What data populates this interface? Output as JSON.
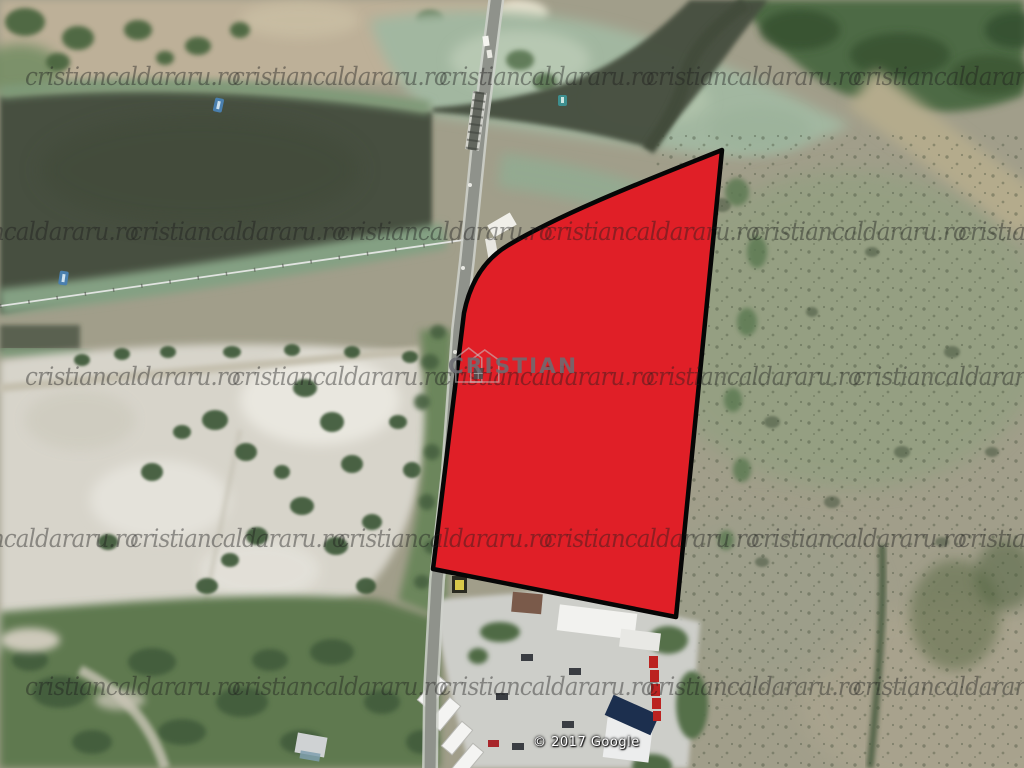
{
  "watermark": {
    "text": "cristiancaldararu.ro",
    "color": "rgba(28,28,28,0.42)"
  },
  "logo": {
    "name": "CRISTIAN",
    "icon": "double-house-outline-icon",
    "color": "#6c6c72"
  },
  "attribution": {
    "text": "© 2017 Google",
    "color": "#ffffff"
  },
  "parcel_overlay": {
    "shape": "land-parcel-polygon",
    "fill": "#e01f27",
    "stroke": "#000000",
    "description": "red highlighted land parcel east of the road"
  },
  "map_features": {
    "type": "satellite-imagery",
    "water": "dark river/lake band across upper left with reed marsh",
    "bridge": "road bridge crossing the river",
    "road": "north-south road left of the highlighted parcel",
    "terrain_left": "large cleared light dirt site with scattered trees",
    "terrain_right": "gray-green scrubland with bushes",
    "bottom_area": "industrial yard: warehouses, parking lot, trucks",
    "markers": "small boats on the water, yellow road sign near parcel corner"
  },
  "palette": {
    "water": "#47503f",
    "reeds": "#a2b7a0",
    "dirt": "#d7d4ca",
    "forest": "#4c663f",
    "scrub": "#a19e8a",
    "road": "#8f928b",
    "parking": "#cdcec9"
  }
}
